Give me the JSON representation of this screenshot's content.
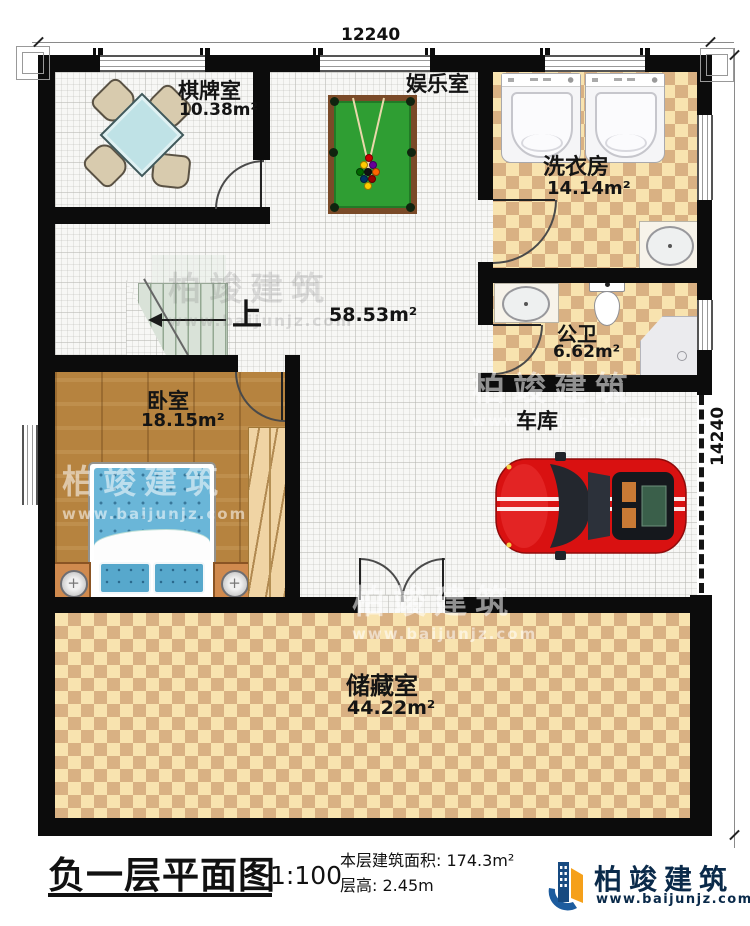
{
  "plan": {
    "dim_top": "12240",
    "dim_right": "14240"
  },
  "rooms": {
    "chess": {
      "name": "棋牌室",
      "area": "10.38m²"
    },
    "entertainment": {
      "name": "娱乐室"
    },
    "laundry": {
      "name": "洗衣房",
      "area": "14.14m²"
    },
    "bathroom": {
      "name": "公卫",
      "area": "6.62m²"
    },
    "hall": {
      "area": "58.53m²",
      "stairs_up": "上"
    },
    "bedroom": {
      "name": "卧室",
      "area": "18.15m²"
    },
    "garage": {
      "name": "车库"
    },
    "storage": {
      "name": "储藏室",
      "area": "44.22m²"
    }
  },
  "title_block": {
    "title": "负一层平面图",
    "scale": "1:100",
    "area_label": "本层建筑面积:",
    "area_value": "174.3m²",
    "height_label": "层高:",
    "height_value": "2.45m"
  },
  "brand": {
    "name": "柏竣建筑",
    "url": "www.baijunjz.com"
  },
  "watermark": {
    "name": "柏竣建筑",
    "url": "www.baijunjz.com"
  },
  "colors": {
    "wall": "#0c0c0c",
    "checker_light": "#f8e3af",
    "checker_dark": "#d9b183",
    "wood": "#b6833f",
    "pool_felt": "#2f9e33",
    "table_blue": "#bfe2e6",
    "bed_blue": "#6ab6d8",
    "car_red": "#d91111",
    "brand_blue": "#1d5c9e",
    "brand_orange": "#f5a01a"
  }
}
